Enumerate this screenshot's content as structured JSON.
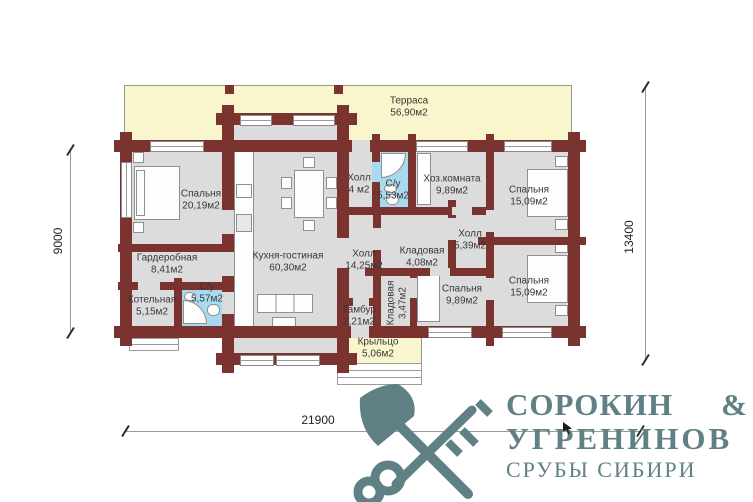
{
  "plan": {
    "rooms": [
      {
        "name": "Терраса",
        "area": "56,90м2"
      },
      {
        "name": "Спальня",
        "area": "20,19м2"
      },
      {
        "name": "Гардеробная",
        "area": "8,41м2"
      },
      {
        "name": "Котельная",
        "area": "5,15м2"
      },
      {
        "name": "С/у",
        "area": "5,57м2"
      },
      {
        "name": "Кухня-гостиная",
        "area": "60,30м2"
      },
      {
        "name": "Холл",
        "area": "4 м2"
      },
      {
        "name": "С/у",
        "area": "5,53м2"
      },
      {
        "name": "Хоз.комната",
        "area": "9,89м2"
      },
      {
        "name": "Спальня",
        "area": "15,09м2"
      },
      {
        "name": "Холл",
        "area": "14,25м2"
      },
      {
        "name": "Кладовая",
        "area": "4,08м2"
      },
      {
        "name": "Холл",
        "area": "5,39м2"
      },
      {
        "name": "Кладовая",
        "area": "3,47м2"
      },
      {
        "name": "Спальня",
        "area": "9,89м2"
      },
      {
        "name": "Тамбур",
        "area": "2,21м2"
      },
      {
        "name": "Спальня",
        "area": "15,09м2"
      },
      {
        "name": "Крыльцо",
        "area": "5,06м2"
      }
    ],
    "dimensions": {
      "left": "9000",
      "right": "13400",
      "bottom": "21900"
    }
  },
  "logo": {
    "line1_left": "СОРОКИН",
    "line1_right": "&",
    "line2": "УГРЕНИНОВ",
    "line3": "СРУБЫ СИБИРИ"
  },
  "colors": {
    "wall": "#7a332f",
    "terrace": "#f9f5cc",
    "room": "#dcdcdc",
    "bathroom": "#a9d9ef",
    "logo": "#5f8084"
  }
}
